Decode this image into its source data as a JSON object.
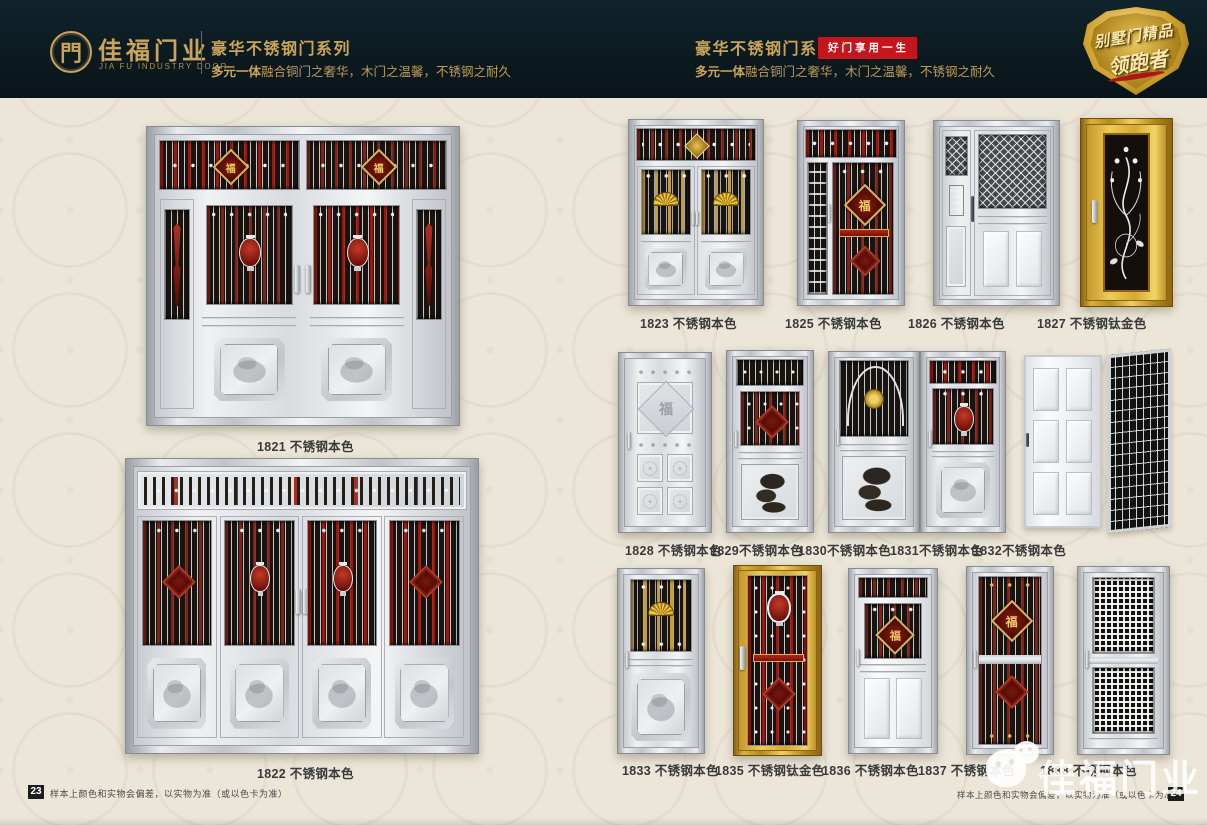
{
  "header": {
    "logo_glyph": "門",
    "brand": "佳福门业",
    "brand_en": "JIA FU INDUSTRY DOOR",
    "series_title": "豪华不锈钢门系列",
    "subtitle_strong": "多元一体",
    "subtitle_rest": "融合铜门之奢华，木门之温馨，不锈钢之耐久",
    "right_series_title": "豪华不锈钢门系列",
    "right_badge": "好门享用一生",
    "emblem_line1": "别墅门精品",
    "emblem_line2": "领跑者"
  },
  "glyphs": {
    "fu": "福"
  },
  "doors": {
    "d1821": "1821 不锈钢本色",
    "d1822": "1822 不锈钢本色",
    "d1823": "1823 不锈钢本色",
    "d1825": "1825 不锈钢本色",
    "d1826": "1826 不锈钢本色",
    "d1827": "1827 不锈钢钛金色",
    "d1828": "1828 不锈钢本色",
    "d1829": "1829不锈钢本色",
    "d1830": "1830不锈钢本色",
    "d1831": "1831不锈钢本色",
    "d1832": "1832不锈钢本色",
    "d1833": "1833 不锈钢本色",
    "d1835": "1835 不锈钢钛金色",
    "d1836": "1836 不锈钢本色",
    "d1837": "1837 不锈钢本色",
    "d1838": "1838 不锈钢本色"
  },
  "footer": {
    "left_page_no": "23",
    "right_page_no": "24",
    "note": "样本上颜色和实物会偏差，以实物为准（或以色卡为准）"
  },
  "watermark": {
    "brand": "佳福门业"
  },
  "colors": {
    "header_bg": "#0c1a20",
    "gold": "#c9a45a",
    "badge_red": "#c4161c",
    "page_bg": "#ece6d9",
    "label_text": "#3a3a3a"
  }
}
